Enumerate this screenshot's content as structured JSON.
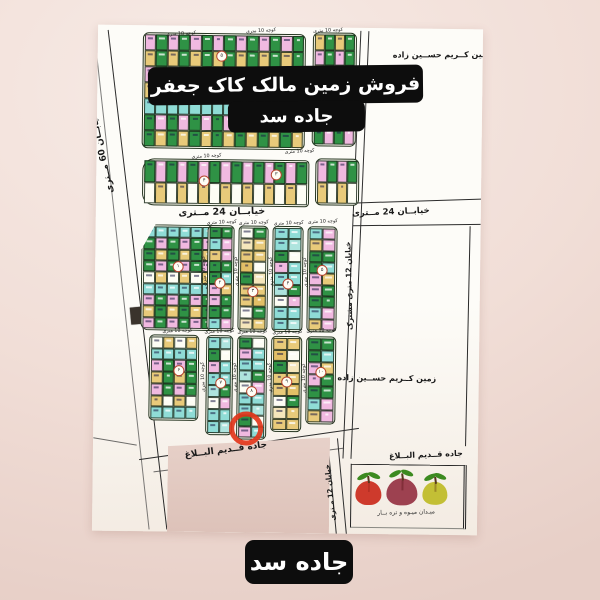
{
  "banner_top": {
    "line1": "فروش زمین مالک کاک جعفر دانا",
    "line2": "جاده سد"
  },
  "banner_bottom": {
    "label": "جاده سد"
  },
  "map": {
    "streets": {
      "street_60": "خیابــان 60 مــتری",
      "street_24_center": "خیابــان 24 مــتری",
      "street_24_right": "خیابــان 24 مــتری",
      "street_12_shared": "خیابان 12 متری مشترک",
      "street_12_bottom": "خیابان 12 مـتری",
      "road_old_diagonal": "جاده قــدیم البــلاغ",
      "road_old_right": "جاده قــدیم البــلاغ",
      "alley": "کوچه 10 متری"
    },
    "parcels": {
      "owner_top": "ـین کــریم حســین زاده",
      "owner_mid": "زمین کــریم حســین زاده",
      "market": "میـدان میـوه و تره بــار"
    },
    "highlight_color": "#e2361b",
    "palettes": {
      "mix": [
        "#f0b9e0",
        "#2f9245",
        "#8fdcd6",
        "#e8ca7a",
        "#fdfdf4",
        "#2f9245",
        "#f0b9e0",
        "#8fdcd6",
        "#2f9245",
        "#e8ca7a"
      ],
      "tan": [
        "#e8ca7a",
        "#fdfdf4",
        "#e8ca7a",
        "#e2bf66",
        "#f5e6bb",
        "#e8ca7a",
        "#2f9245"
      ],
      "cyan": [
        "#8fdcd6",
        "#2f9245",
        "#8fdcd6",
        "#aee4de",
        "#f0b9e0",
        "#8fdcd6",
        "#fdfdf4"
      ],
      "gp": [
        "#2f9245",
        "#f0b9e0",
        "#2f9245",
        "#8fdcd6",
        "#f0b9e0",
        "#2f9245",
        "#e8ca7a"
      ]
    },
    "blocks": [
      {
        "x": 45,
        "y": 7,
        "w": 163,
        "h": 116,
        "cols": 14,
        "rows": 7,
        "r": "6px",
        "pal": "mix",
        "seed": 0
      },
      {
        "x": 215,
        "y": 5,
        "w": 44,
        "h": 114,
        "cols": 4,
        "rows": 7,
        "r": "6px",
        "pal": "mix",
        "seed": 3
      },
      {
        "x": 46,
        "y": 133,
        "w": 167,
        "h": 47,
        "cols": 15,
        "rows": 2,
        "r": "12px 4px 4px 12px",
        "pal": "mix",
        "seed": 1
      },
      {
        "x": 219,
        "y": 131,
        "w": 44,
        "h": 47,
        "cols": 4,
        "rows": 2,
        "r": "6px",
        "pal": "mix",
        "seed": 6
      },
      {
        "x": 46,
        "y": 199,
        "w": 87,
        "h": 106,
        "cols": 7,
        "rows": 9,
        "r": "8px",
        "pal": "mix",
        "seed": 2,
        "clip": "polygon(16% 0,100% 0,100% 100%,0 100%,0 24%)"
      },
      {
        "x": 112,
        "y": 199,
        "w": 27,
        "h": 106,
        "cols": 2,
        "rows": 9,
        "r": "5px",
        "pal": "gp",
        "seed": 0
      },
      {
        "x": 143,
        "y": 199,
        "w": 30,
        "h": 106,
        "cols": 2,
        "rows": 9,
        "r": "5px",
        "pal": "tan",
        "seed": 1
      },
      {
        "x": 177,
        "y": 199,
        "w": 31,
        "h": 106,
        "cols": 2,
        "rows": 9,
        "r": "5px",
        "pal": "cyan",
        "seed": 2
      },
      {
        "x": 212,
        "y": 199,
        "w": 30,
        "h": 106,
        "cols": 2,
        "rows": 9,
        "r": "5px",
        "pal": "gp",
        "seed": 3
      },
      {
        "x": 55,
        "y": 309,
        "w": 50,
        "h": 86,
        "cols": 4,
        "rows": 7,
        "r": "5px",
        "pal": "mix",
        "seed": 4
      },
      {
        "x": 112,
        "y": 309,
        "w": 27,
        "h": 100,
        "cols": 2,
        "rows": 8,
        "r": "5px",
        "pal": "cyan",
        "seed": 5
      },
      {
        "x": 143,
        "y": 309,
        "w": 30,
        "h": 104,
        "cols": 2,
        "rows": 9,
        "r": "5px",
        "pal": "cyan",
        "seed": 1
      },
      {
        "x": 177,
        "y": 309,
        "w": 31,
        "h": 96,
        "cols": 2,
        "rows": 8,
        "r": "5px",
        "pal": "tan",
        "seed": 0
      },
      {
        "x": 212,
        "y": 309,
        "w": 30,
        "h": 88,
        "cols": 2,
        "rows": 7,
        "r": "5px",
        "pal": "gp",
        "seed": 2
      }
    ],
    "alley_labels": [
      {
        "x": 83,
        "y": 8,
        "rot": -4
      },
      {
        "x": 163,
        "y": 4,
        "rot": -4
      },
      {
        "x": 230,
        "y": 3,
        "rot": -4
      },
      {
        "x": 110,
        "y": 130,
        "rot": -4
      },
      {
        "x": 203,
        "y": 124,
        "rot": -4
      },
      {
        "x": 126,
        "y": 196,
        "rot": -3
      },
      {
        "x": 158,
        "y": 196,
        "rot": -3
      },
      {
        "x": 193,
        "y": 196,
        "rot": -3
      },
      {
        "x": 227,
        "y": 194,
        "rot": -3
      },
      {
        "x": 83,
        "y": 305,
        "rot": -3
      },
      {
        "x": 125,
        "y": 305,
        "rot": -3
      },
      {
        "x": 158,
        "y": 305,
        "rot": -3
      },
      {
        "x": 193,
        "y": 305,
        "rot": -3
      },
      {
        "x": 227,
        "y": 303,
        "rot": -3
      },
      {
        "x": 109,
        "y": 245,
        "rot": -93
      },
      {
        "x": 141,
        "y": 245,
        "rot": -93
      },
      {
        "x": 176,
        "y": 245,
        "rot": -93
      },
      {
        "x": 210,
        "y": 245,
        "rot": -93
      },
      {
        "x": 109,
        "y": 351,
        "rot": -93
      },
      {
        "x": 141,
        "y": 351,
        "rot": -93
      },
      {
        "x": 176,
        "y": 351,
        "rot": -93
      },
      {
        "x": 210,
        "y": 351,
        "rot": -93
      }
    ],
    "badges": [
      {
        "x": 124,
        "y": 30,
        "n": "۵"
      },
      {
        "x": 108,
        "y": 155,
        "n": "۴"
      },
      {
        "x": 180,
        "y": 148,
        "n": "۳"
      },
      {
        "x": 83,
        "y": 241,
        "n": "۱"
      },
      {
        "x": 125,
        "y": 257,
        "n": "۲"
      },
      {
        "x": 158,
        "y": 265,
        "n": "۳"
      },
      {
        "x": 193,
        "y": 257,
        "n": "۴"
      },
      {
        "x": 227,
        "y": 243,
        "n": "۵"
      },
      {
        "x": 85,
        "y": 345,
        "n": "۶"
      },
      {
        "x": 127,
        "y": 357,
        "n": "۷"
      },
      {
        "x": 158,
        "y": 365,
        "n": "۸"
      },
      {
        "x": 193,
        "y": 355,
        "n": "۹"
      },
      {
        "x": 227,
        "y": 345,
        "n": "۱۰"
      }
    ],
    "apples": [
      {
        "name": "red-apple",
        "c": "#ce3a2c",
        "x": 262,
        "y": 452,
        "w": 26,
        "h": 24
      },
      {
        "name": "maroon-apple",
        "c": "#9d4150",
        "x": 293,
        "y": 449,
        "w": 31,
        "h": 27
      },
      {
        "name": "yellow-apple",
        "c": "#c3bf35",
        "x": 329,
        "y": 452,
        "w": 25,
        "h": 23
      }
    ]
  }
}
